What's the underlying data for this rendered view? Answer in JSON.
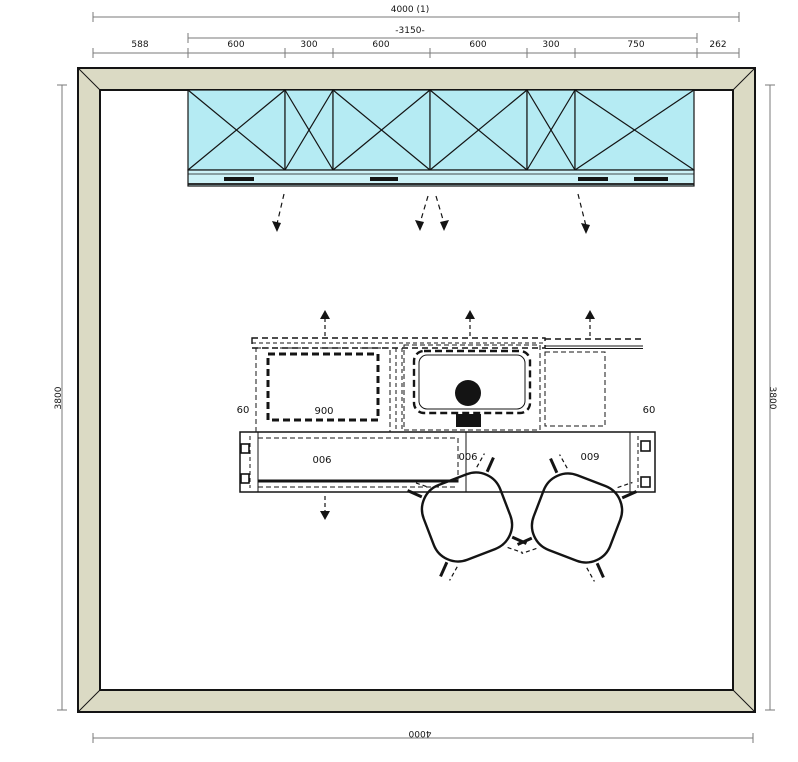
{
  "dimensions": {
    "top_total": "4000 (1)",
    "top_sub": "-3150-",
    "top_segments": [
      "588",
      "600",
      "300",
      "600",
      "600",
      "300",
      "750",
      "262"
    ],
    "left_side": "3800",
    "right_side": "3800",
    "bottom": "4000"
  },
  "island": {
    "offset_left": "60",
    "offset_right": "60",
    "cooktop_width": "900",
    "front_left": "006",
    "front_mid": "006",
    "front_right": "009"
  },
  "colors": {
    "wall_fill": "#dbdac4",
    "cabinet_fill": "#b5ebf3",
    "cabinet_strip_fill": "#cdf2f7",
    "dim_line": "#7a7a7a",
    "ink": "#141414"
  }
}
